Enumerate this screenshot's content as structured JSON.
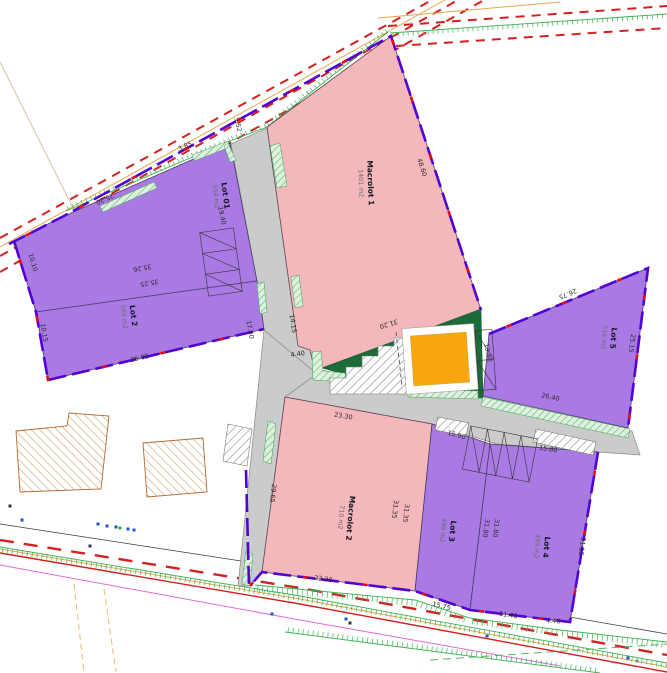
{
  "drawing": {
    "kind": "parcel-subdivision-site-plan",
    "lots": [
      {
        "id": "macrolot1",
        "name": "Macrolot 1",
        "area": "1401 m2",
        "fill": "pink",
        "label": {
          "x": 368,
          "y": 183,
          "r": 88
        }
      },
      {
        "id": "lot01",
        "name": "Lot 01",
        "area": "554 m2",
        "fill": "purple",
        "label": {
          "x": 223,
          "y": 196,
          "r": 83
        }
      },
      {
        "id": "lot2",
        "name": "Lot 2",
        "area": "580 m2",
        "fill": "purple",
        "label": {
          "x": 131,
          "y": 316,
          "r": 83
        }
      },
      {
        "id": "lot5",
        "name": "Lot 5",
        "area": "514 m2",
        "fill": "purple",
        "label": {
          "x": 611,
          "y": 338,
          "r": 95
        }
      },
      {
        "id": "macrolot2",
        "name": "Macrolot 2",
        "area": "710 m2",
        "fill": "pink",
        "label": {
          "x": 348,
          "y": 518,
          "r": 95
        }
      },
      {
        "id": "lot3",
        "name": "Lot 3",
        "area": "499 m2",
        "fill": "purple",
        "label": {
          "x": 450,
          "y": 531,
          "r": 96
        }
      },
      {
        "id": "lot4",
        "name": "Lot 4",
        "area": "499 m2",
        "fill": "purple",
        "label": {
          "x": 544,
          "y": 547,
          "r": 96
        }
      }
    ],
    "dimensions": [
      {
        "t": "25.20",
        "x": 104,
        "y": 197,
        "r": 156
      },
      {
        "t": "5.52",
        "x": 236,
        "y": 125,
        "r": 78
      },
      {
        "t": "3.85",
        "x": 186,
        "y": 148,
        "r": -25
      },
      {
        "t": "19.40",
        "x": 220,
        "y": 216,
        "r": 78
      },
      {
        "t": "48.60",
        "x": 420,
        "y": 168,
        "r": 72
      },
      {
        "t": "10.10",
        "x": 31,
        "y": 263,
        "r": 73
      },
      {
        "t": "10.15",
        "x": 42,
        "y": 333,
        "r": 80
      },
      {
        "t": "35.26",
        "x": 142,
        "y": 266,
        "r": 170
      },
      {
        "t": "35.25",
        "x": 149,
        "y": 281,
        "r": 170
      },
      {
        "t": "36.00",
        "x": 140,
        "y": 360,
        "r": -13
      },
      {
        "t": "17.40",
        "x": 248,
        "y": 330,
        "r": 80
      },
      {
        "t": "14.15",
        "x": 291,
        "y": 324,
        "r": 81
      },
      {
        "t": "4.40",
        "x": 298,
        "y": 356,
        "r": -8
      },
      {
        "t": "31.20",
        "x": 388,
        "y": 322,
        "r": 163
      },
      {
        "t": "13.40",
        "x": 486,
        "y": 353,
        "r": 79
      },
      {
        "t": "26.75",
        "x": 567,
        "y": 292,
        "r": 157
      },
      {
        "t": "25.15",
        "x": 630,
        "y": 343,
        "r": 97
      },
      {
        "t": "26.40",
        "x": 550,
        "y": 399,
        "r": 12
      },
      {
        "t": "23.30",
        "x": 343,
        "y": 418,
        "r": 10
      },
      {
        "t": "15.90",
        "x": 456,
        "y": 437,
        "r": 15
      },
      {
        "t": "15.80",
        "x": 548,
        "y": 451,
        "r": 8
      },
      {
        "t": "31.35",
        "x": 393,
        "y": 509,
        "r": 96
      },
      {
        "t": "31.35",
        "x": 404,
        "y": 513,
        "r": 96
      },
      {
        "t": "31.80",
        "x": 484,
        "y": 528,
        "r": 97
      },
      {
        "t": "31.80",
        "x": 494,
        "y": 528,
        "r": 97
      },
      {
        "t": "31.15",
        "x": 580,
        "y": 546,
        "r": 99
      },
      {
        "t": "29.65",
        "x": 271,
        "y": 493,
        "r": 97
      },
      {
        "t": "23.30",
        "x": 323,
        "y": 581,
        "r": 8
      },
      {
        "t": "15.75",
        "x": 441,
        "y": 608,
        "r": 14
      },
      {
        "t": "11.40",
        "x": 508,
        "y": 617,
        "r": 9
      },
      {
        "t": "4.40",
        "x": 553,
        "y": 623,
        "r": 5
      }
    ],
    "colors": {
      "pink": "#f4b7bb",
      "purple": "#aa7ae4",
      "road": "#cbcbcb",
      "darkgreen": "#1e6b3a",
      "orange_building": "#f7a70d",
      "boundary": "#5202d6",
      "boundaryred": "#e80c0c",
      "reddash": "#d42020",
      "orangeline": "#e8a64e",
      "magenta": "#e06ad8"
    }
  }
}
